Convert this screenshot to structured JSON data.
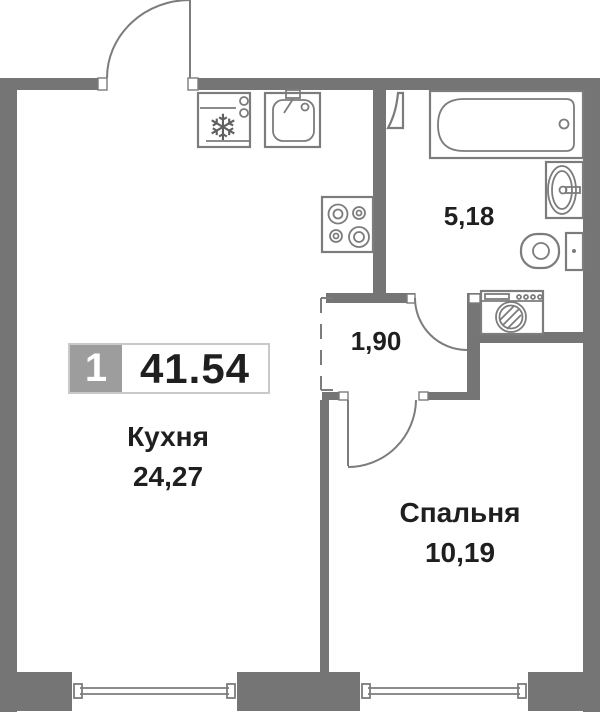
{
  "unit": {
    "number": "1",
    "total_area": "41.54"
  },
  "rooms": {
    "kitchen": {
      "name": "Кухня",
      "area": "24,27"
    },
    "bedroom": {
      "name": "Спальня",
      "area": "10,19"
    },
    "bathroom": {
      "area": "5,18"
    },
    "hallway": {
      "area": "1,90"
    }
  },
  "icons": {
    "fridge_glyph": "❄"
  },
  "colors": {
    "wall": "#757575",
    "line": "#7c7c7c",
    "badge": "#9d9d9d",
    "text": "#1f1f1f",
    "border": "#c9c9c9",
    "bg": "#ffffff"
  }
}
